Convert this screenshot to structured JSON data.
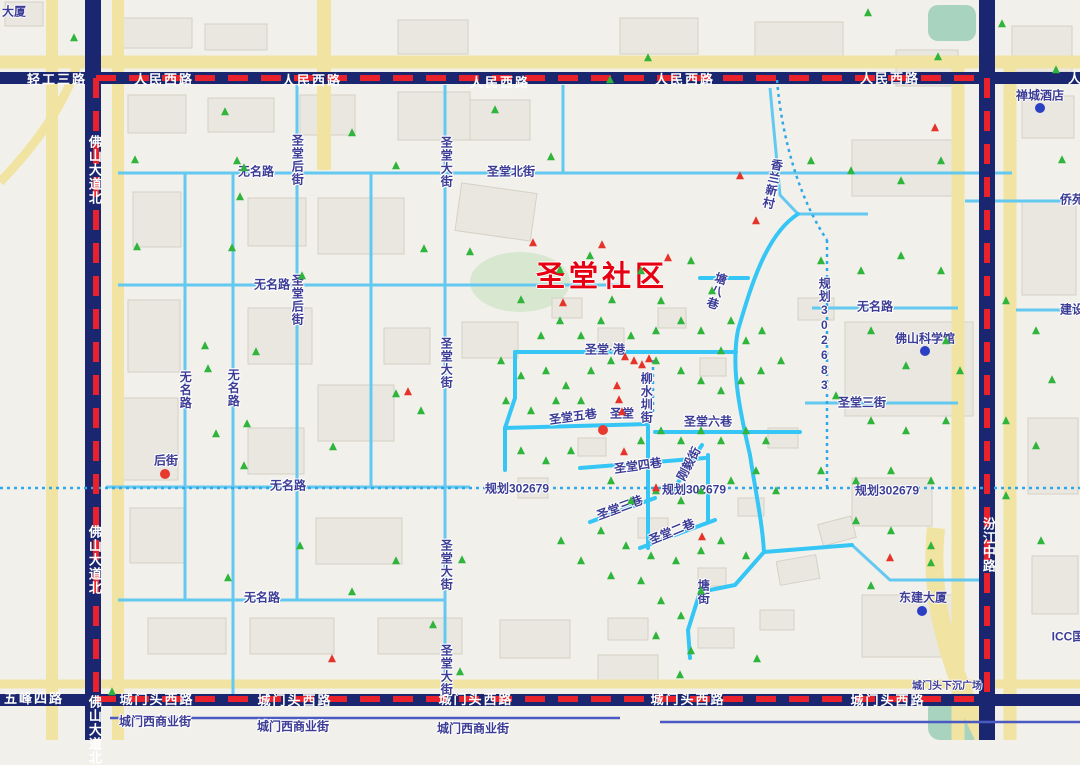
{
  "map": {
    "community_label": {
      "text": "圣堂社区",
      "x": 602,
      "y": 277
    },
    "colors": {
      "boundary_red": "#e8212a",
      "major_road_navy": "#1b2670",
      "minor_road_cyan": "#63c9f1",
      "highlight_road_cyan": "#35c6f5",
      "planned_road_blue": "#2fa8e8",
      "road_fill_yellow": "#f1e3a2",
      "label_indigo": "#3c3c96",
      "community_red": "#e60012",
      "green_marker": "#2fb43c",
      "red_marker": "#e63329",
      "poi_dot_blue": "#2b3fc4",
      "park_green": "#d8e7cf",
      "water_teal": "#a8d4bf"
    },
    "labels": [
      {
        "t": "轻工三路",
        "x": 57,
        "y": 80,
        "s": "major"
      },
      {
        "t": "人民西路",
        "x": 164,
        "y": 80,
        "s": "major"
      },
      {
        "t": "人民西路",
        "x": 312,
        "y": 81,
        "s": "major"
      },
      {
        "t": "人民西路",
        "x": 500,
        "y": 83,
        "s": "major"
      },
      {
        "t": "人民西路",
        "x": 685,
        "y": 80,
        "s": "major"
      },
      {
        "t": "人民西路",
        "x": 890,
        "y": 79,
        "s": "major"
      },
      {
        "t": "人民西路",
        "x": 1098,
        "y": 79,
        "s": "major"
      },
      {
        "t": "佛山大道北",
        "x": 94,
        "y": 170,
        "s": "major",
        "v": 1
      },
      {
        "t": "佛山大道北",
        "x": 94,
        "y": 560,
        "s": "major",
        "v": 1
      },
      {
        "t": "佛山大道北",
        "x": 94,
        "y": 730,
        "s": "major",
        "v": 1
      },
      {
        "t": "汾江中路",
        "x": 988,
        "y": 545,
        "s": "major",
        "v": 1
      },
      {
        "t": "城门头西路",
        "x": 157,
        "y": 700,
        "s": "major"
      },
      {
        "t": "城门头西路",
        "x": 295,
        "y": 701,
        "s": "major"
      },
      {
        "t": "城门头西路",
        "x": 476,
        "y": 700,
        "s": "major"
      },
      {
        "t": "城门头西路",
        "x": 688,
        "y": 700,
        "s": "major"
      },
      {
        "t": "城门头西路",
        "x": 888,
        "y": 701,
        "s": "major"
      },
      {
        "t": "五峰四路",
        "x": 34,
        "y": 699,
        "s": "major"
      },
      {
        "t": "城门西商业街",
        "x": 155,
        "y": 722,
        "s": "street"
      },
      {
        "t": "城门西商业街",
        "x": 293,
        "y": 727,
        "s": "street"
      },
      {
        "t": "城门西商业街",
        "x": 473,
        "y": 729,
        "s": "street"
      },
      {
        "t": "无名路",
        "x": 185,
        "y": 390,
        "s": "street",
        "v": 1
      },
      {
        "t": "无名路",
        "x": 233,
        "y": 388,
        "s": "street",
        "v": 1
      },
      {
        "t": "无名路",
        "x": 288,
        "y": 486,
        "s": "street"
      },
      {
        "t": "无名路",
        "x": 262,
        "y": 598,
        "s": "street"
      },
      {
        "t": "无名路",
        "x": 272,
        "y": 285,
        "s": "street"
      },
      {
        "t": "无名路",
        "x": 256,
        "y": 172,
        "s": "street"
      },
      {
        "t": "无名路",
        "x": 875,
        "y": 307,
        "s": "street"
      },
      {
        "t": "圣堂后街",
        "x": 297,
        "y": 160,
        "s": "street",
        "v": 1
      },
      {
        "t": "圣堂后街",
        "x": 297,
        "y": 300,
        "s": "street",
        "v": 1
      },
      {
        "t": "圣堂大街",
        "x": 446,
        "y": 162,
        "s": "street",
        "v": 1
      },
      {
        "t": "圣堂大街",
        "x": 446,
        "y": 363,
        "s": "street",
        "v": 1
      },
      {
        "t": "圣堂大街",
        "x": 446,
        "y": 565,
        "s": "street",
        "v": 1
      },
      {
        "t": "圣堂大街",
        "x": 446,
        "y": 670,
        "s": "street",
        "v": 1
      },
      {
        "t": "圣堂北街",
        "x": 511,
        "y": 172,
        "s": "street"
      },
      {
        "t": "圣堂·港",
        "x": 605,
        "y": 350,
        "s": "street"
      },
      {
        "t": "圣堂六巷",
        "x": 708,
        "y": 422,
        "s": "street"
      },
      {
        "t": "圣堂五巷",
        "x": 573,
        "y": 417,
        "s": "street",
        "r": -8
      },
      {
        "t": "圣堂",
        "x": 622,
        "y": 414,
        "s": "street"
      },
      {
        "t": "圣堂四巷",
        "x": 638,
        "y": 466,
        "s": "street",
        "r": -8
      },
      {
        "t": "圣堂三巷",
        "x": 620,
        "y": 508,
        "s": "street",
        "r": -20
      },
      {
        "t": "圣堂二巷",
        "x": 672,
        "y": 532,
        "s": "street",
        "r": -22
      },
      {
        "t": "刚毅街",
        "x": 689,
        "y": 464,
        "s": "street",
        "r": -62
      },
      {
        "t": "塘八巷",
        "x": 716,
        "y": 291,
        "s": "street",
        "v": 1,
        "r": 18
      },
      {
        "t": "柳水圳街",
        "x": 646,
        "y": 398,
        "s": "street",
        "v": 1
      },
      {
        "t": "塘街",
        "x": 703,
        "y": 592,
        "s": "street",
        "v": 1
      },
      {
        "t": "香兰新村",
        "x": 772,
        "y": 184,
        "s": "street",
        "v": 1,
        "r": 12
      },
      {
        "t": "规划302683",
        "x": 824,
        "y": 335,
        "s": "street",
        "v": 1
      },
      {
        "t": "规划302679",
        "x": 517,
        "y": 489,
        "s": "street"
      },
      {
        "t": "规划302679",
        "x": 694,
        "y": 490,
        "s": "street"
      },
      {
        "t": "规划302679",
        "x": 887,
        "y": 491,
        "s": "street"
      },
      {
        "t": "圣堂三街",
        "x": 862,
        "y": 403,
        "s": "street"
      },
      {
        "t": "侨苑",
        "x": 1072,
        "y": 200,
        "s": "street"
      },
      {
        "t": "建设",
        "x": 1072,
        "y": 310,
        "s": "street"
      },
      {
        "t": "后街",
        "x": 166,
        "y": 461,
        "s": "street"
      },
      {
        "t": "城门头下沉广场",
        "x": 947,
        "y": 687,
        "s": "sm"
      },
      {
        "t": "禅城酒店",
        "x": 1040,
        "y": 96,
        "s": "poi"
      },
      {
        "t": "佛山科学馆",
        "x": 925,
        "y": 339,
        "s": "poi"
      },
      {
        "t": "东建大厦",
        "x": 923,
        "y": 598,
        "s": "poi"
      },
      {
        "t": "ICC国",
        "x": 1068,
        "y": 637,
        "s": "poi"
      },
      {
        "t": "大厦",
        "x": 14,
        "y": 12,
        "s": "poi"
      }
    ],
    "markers": {
      "blue_dots": [
        [
          1040,
          108
        ],
        [
          925,
          351
        ],
        [
          922,
          611
        ]
      ],
      "red_dots": [
        [
          165,
          474
        ],
        [
          603,
          430
        ]
      ],
      "red_triangles": [
        [
          533,
          243
        ],
        [
          602,
          245
        ],
        [
          668,
          258
        ],
        [
          563,
          303
        ],
        [
          740,
          176
        ],
        [
          756,
          221
        ],
        [
          625,
          357
        ],
        [
          634,
          361
        ],
        [
          642,
          365
        ],
        [
          649,
          359
        ],
        [
          617,
          386
        ],
        [
          619,
          400
        ],
        [
          622,
          412
        ],
        [
          624,
          452
        ],
        [
          408,
          392
        ],
        [
          656,
          488
        ],
        [
          702,
          537
        ],
        [
          890,
          558
        ],
        [
          332,
          659
        ],
        [
          935,
          128
        ]
      ],
      "green_triangles": [
        [
          74,
          38
        ],
        [
          225,
          112
        ],
        [
          135,
          160
        ],
        [
          237,
          161
        ],
        [
          352,
          133
        ],
        [
          244,
          168
        ],
        [
          396,
          166
        ],
        [
          495,
          110
        ],
        [
          551,
          157
        ],
        [
          610,
          80
        ],
        [
          648,
          58
        ],
        [
          868,
          13
        ],
        [
          938,
          57
        ],
        [
          1002,
          24
        ],
        [
          1056,
          70
        ],
        [
          137,
          247
        ],
        [
          240,
          197
        ],
        [
          232,
          248
        ],
        [
          424,
          249
        ],
        [
          302,
          276
        ],
        [
          205,
          346
        ],
        [
          256,
          352
        ],
        [
          208,
          369
        ],
        [
          216,
          434
        ],
        [
          247,
          424
        ],
        [
          333,
          447
        ],
        [
          244,
          466
        ],
        [
          396,
          394
        ],
        [
          421,
          411
        ],
        [
          300,
          546
        ],
        [
          228,
          578
        ],
        [
          396,
          561
        ],
        [
          352,
          592
        ],
        [
          433,
          625
        ],
        [
          462,
          560
        ],
        [
          460,
          672
        ],
        [
          680,
          675
        ],
        [
          757,
          659
        ],
        [
          112,
          692
        ],
        [
          470,
          252
        ],
        [
          521,
          300
        ],
        [
          560,
          270
        ],
        [
          590,
          256
        ],
        [
          612,
          300
        ],
        [
          641,
          271
        ],
        [
          661,
          301
        ],
        [
          691,
          261
        ],
        [
          712,
          291
        ],
        [
          731,
          321
        ],
        [
          560,
          321
        ],
        [
          541,
          336
        ],
        [
          581,
          336
        ],
        [
          601,
          321
        ],
        [
          631,
          336
        ],
        [
          656,
          331
        ],
        [
          681,
          321
        ],
        [
          701,
          331
        ],
        [
          721,
          351
        ],
        [
          746,
          341
        ],
        [
          762,
          331
        ],
        [
          501,
          361
        ],
        [
          521,
          376
        ],
        [
          546,
          371
        ],
        [
          566,
          386
        ],
        [
          591,
          371
        ],
        [
          611,
          361
        ],
        [
          656,
          361
        ],
        [
          681,
          371
        ],
        [
          701,
          381
        ],
        [
          721,
          391
        ],
        [
          741,
          381
        ],
        [
          761,
          371
        ],
        [
          781,
          361
        ],
        [
          506,
          401
        ],
        [
          531,
          411
        ],
        [
          556,
          401
        ],
        [
          581,
          401
        ],
        [
          641,
          441
        ],
        [
          661,
          431
        ],
        [
          681,
          441
        ],
        [
          701,
          431
        ],
        [
          721,
          441
        ],
        [
          746,
          431
        ],
        [
          766,
          441
        ],
        [
          521,
          451
        ],
        [
          546,
          461
        ],
        [
          571,
          451
        ],
        [
          611,
          481
        ],
        [
          631,
          501
        ],
        [
          656,
          491
        ],
        [
          681,
          501
        ],
        [
          701,
          491
        ],
        [
          731,
          481
        ],
        [
          756,
          471
        ],
        [
          776,
          491
        ],
        [
          601,
          531
        ],
        [
          626,
          546
        ],
        [
          651,
          556
        ],
        [
          676,
          561
        ],
        [
          701,
          551
        ],
        [
          721,
          541
        ],
        [
          746,
          556
        ],
        [
          641,
          581
        ],
        [
          661,
          601
        ],
        [
          681,
          616
        ],
        [
          701,
          591
        ],
        [
          656,
          636
        ],
        [
          691,
          651
        ],
        [
          611,
          576
        ],
        [
          581,
          561
        ],
        [
          561,
          541
        ],
        [
          811,
          161
        ],
        [
          851,
          171
        ],
        [
          901,
          181
        ],
        [
          941,
          161
        ],
        [
          821,
          261
        ],
        [
          861,
          271
        ],
        [
          901,
          256
        ],
        [
          941,
          271
        ],
        [
          1006,
          301
        ],
        [
          1036,
          331
        ],
        [
          871,
          331
        ],
        [
          906,
          366
        ],
        [
          946,
          341
        ],
        [
          836,
          396
        ],
        [
          871,
          421
        ],
        [
          906,
          431
        ],
        [
          946,
          421
        ],
        [
          1006,
          421
        ],
        [
          1036,
          446
        ],
        [
          821,
          471
        ],
        [
          856,
          481
        ],
        [
          891,
          471
        ],
        [
          931,
          481
        ],
        [
          1006,
          496
        ],
        [
          856,
          521
        ],
        [
          891,
          531
        ],
        [
          931,
          546
        ],
        [
          1041,
          541
        ],
        [
          871,
          586
        ],
        [
          931,
          563
        ],
        [
          1052,
          380
        ],
        [
          1062,
          160
        ],
        [
          960,
          371
        ]
      ]
    },
    "buildings": [
      [
        5,
        2,
        38,
        24,
        0
      ],
      [
        118,
        18,
        74,
        30,
        0
      ],
      [
        205,
        24,
        62,
        26,
        0
      ],
      [
        398,
        20,
        70,
        34,
        0
      ],
      [
        620,
        18,
        78,
        36,
        0
      ],
      [
        755,
        22,
        88,
        40,
        0
      ],
      [
        896,
        50,
        62,
        36,
        0
      ],
      [
        1012,
        26,
        60,
        46,
        0
      ],
      [
        128,
        95,
        58,
        38,
        0
      ],
      [
        208,
        98,
        66,
        34,
        0
      ],
      [
        300,
        95,
        55,
        40,
        0
      ],
      [
        398,
        92,
        72,
        48,
        0
      ],
      [
        470,
        100,
        60,
        40,
        0
      ],
      [
        133,
        192,
        48,
        55,
        0
      ],
      [
        128,
        300,
        52,
        72,
        0
      ],
      [
        122,
        398,
        56,
        82,
        0
      ],
      [
        130,
        508,
        55,
        55,
        0
      ],
      [
        148,
        618,
        78,
        36,
        0
      ],
      [
        248,
        198,
        58,
        48,
        0
      ],
      [
        318,
        198,
        86,
        56,
        0
      ],
      [
        248,
        308,
        64,
        56,
        0
      ],
      [
        318,
        385,
        76,
        56,
        0
      ],
      [
        248,
        428,
        56,
        46,
        0
      ],
      [
        316,
        518,
        86,
        46,
        0
      ],
      [
        250,
        618,
        84,
        36,
        0
      ],
      [
        378,
        618,
        84,
        36,
        0
      ],
      [
        458,
        188,
        76,
        48,
        8
      ],
      [
        462,
        322,
        56,
        36,
        0
      ],
      [
        384,
        328,
        46,
        36,
        0
      ],
      [
        500,
        620,
        70,
        38,
        0
      ],
      [
        598,
        655,
        60,
        26,
        0
      ],
      [
        845,
        322,
        128,
        94,
        0
      ],
      [
        852,
        140,
        108,
        56,
        0
      ],
      [
        1022,
        200,
        54,
        95,
        0
      ],
      [
        1028,
        418,
        50,
        76,
        0
      ],
      [
        852,
        478,
        80,
        48,
        0
      ],
      [
        862,
        595,
        92,
        62,
        0
      ],
      [
        1032,
        556,
        46,
        58,
        0
      ],
      [
        1022,
        96,
        52,
        42,
        0
      ],
      [
        552,
        298,
        30,
        20,
        0
      ],
      [
        598,
        328,
        26,
        18,
        0
      ],
      [
        658,
        308,
        28,
        20,
        0
      ],
      [
        700,
        358,
        26,
        18,
        0
      ],
      [
        578,
        438,
        28,
        18,
        0
      ],
      [
        638,
        518,
        30,
        20,
        0
      ],
      [
        698,
        568,
        28,
        18,
        0
      ],
      [
        738,
        498,
        26,
        18,
        0
      ],
      [
        518,
        478,
        30,
        20,
        0
      ],
      [
        608,
        618,
        40,
        22,
        0
      ],
      [
        698,
        628,
        36,
        20,
        0
      ],
      [
        778,
        558,
        40,
        24,
        -10
      ],
      [
        798,
        298,
        36,
        22,
        0
      ],
      [
        768,
        428,
        30,
        20,
        0
      ],
      [
        820,
        520,
        34,
        22,
        -15
      ],
      [
        760,
        610,
        34,
        20,
        0
      ]
    ]
  }
}
